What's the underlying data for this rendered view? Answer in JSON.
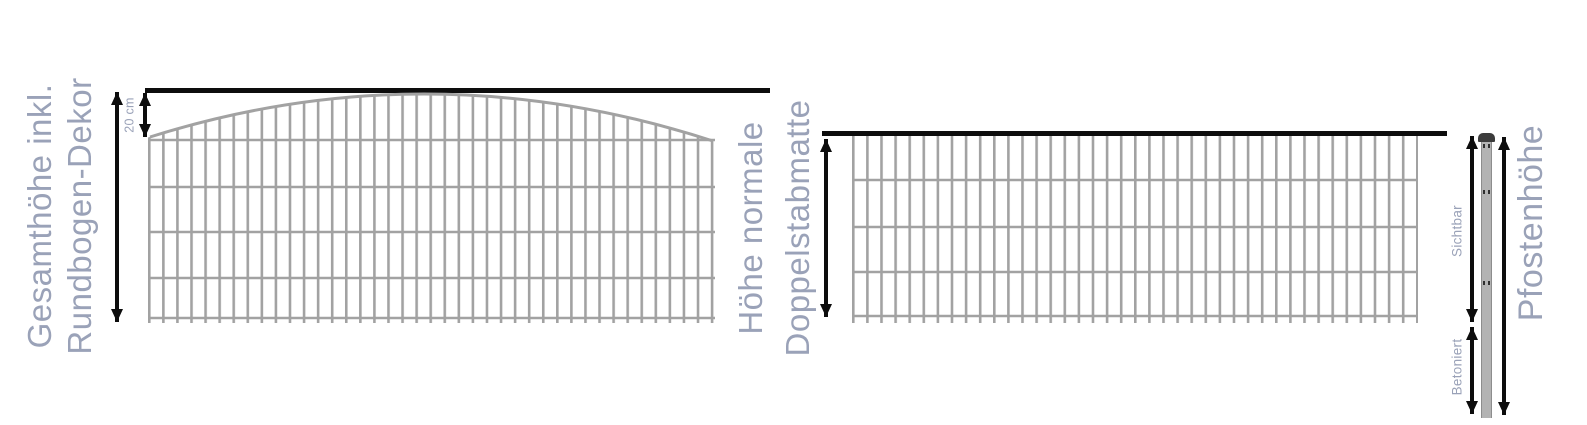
{
  "diagram": {
    "title_hint": "fence dimension diagram",
    "left_panel": {
      "label_line1": "Gesamthöhe inkl.",
      "label_line2": "Rundbogen-Dekor",
      "arch_label": "20 cm"
    },
    "middle_panel": {
      "label_line1": "Höhe normale",
      "label_line2": "Doppelstabmatte"
    },
    "post": {
      "label": "Pfostenhöhe",
      "visible_label": "Sichtbar",
      "concreted_label": "Betoniert"
    },
    "colors": {
      "label_text": "#9aa2b8",
      "mesh": "#a2a2a2",
      "line": "#0d0d0d",
      "post_fill": "#b3b3b3",
      "post_cap": "#3c3c3c",
      "post_hole": "#2e2e2e"
    }
  }
}
